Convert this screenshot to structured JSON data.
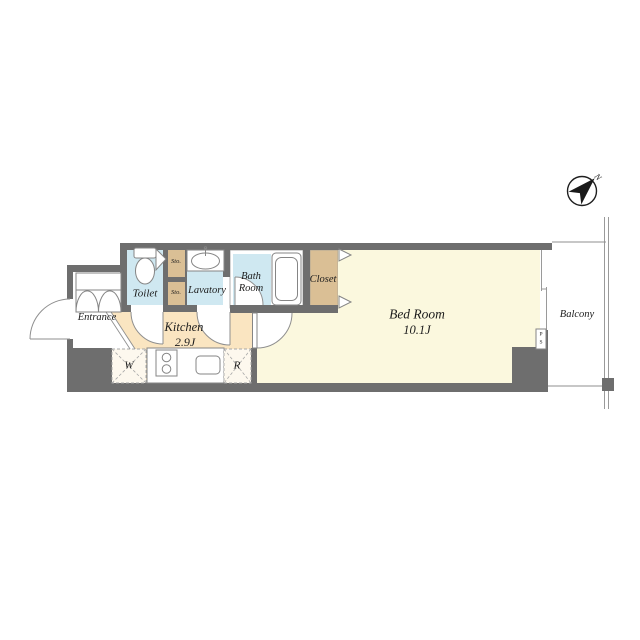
{
  "floor_plan": {
    "rooms": {
      "entrance": {
        "label": "Entrance"
      },
      "toilet": {
        "label": "Toilet"
      },
      "storage_upper": {
        "label": "Sto."
      },
      "storage_lower": {
        "label": "Sto."
      },
      "lavatory": {
        "label": "Lavatory"
      },
      "bath_room": {
        "line1": "Bath",
        "line2": "Room"
      },
      "closet": {
        "label": "Closet"
      },
      "kitchen": {
        "label": "Kitchen",
        "area": "2.9J"
      },
      "bed_room": {
        "label": "Bed Room",
        "area": "10.1J"
      },
      "balcony": {
        "label": "Balcony"
      }
    },
    "annotations": {
      "washing_machine": {
        "label": "W"
      },
      "refrigerator": {
        "label": "R"
      },
      "pipe_shaft": {
        "line1": "P",
        "line2": "S"
      },
      "compass_north": {
        "label": "N"
      }
    },
    "colors": {
      "wall": "#6e6e6e",
      "wet_area": "#cfe8f1",
      "storage": "#dabf95",
      "kitchen_floor": "#fae5c1",
      "bedroom_floor": "#fbf8de",
      "line": "#8f8f8f",
      "text": "#1c1c1c"
    }
  }
}
